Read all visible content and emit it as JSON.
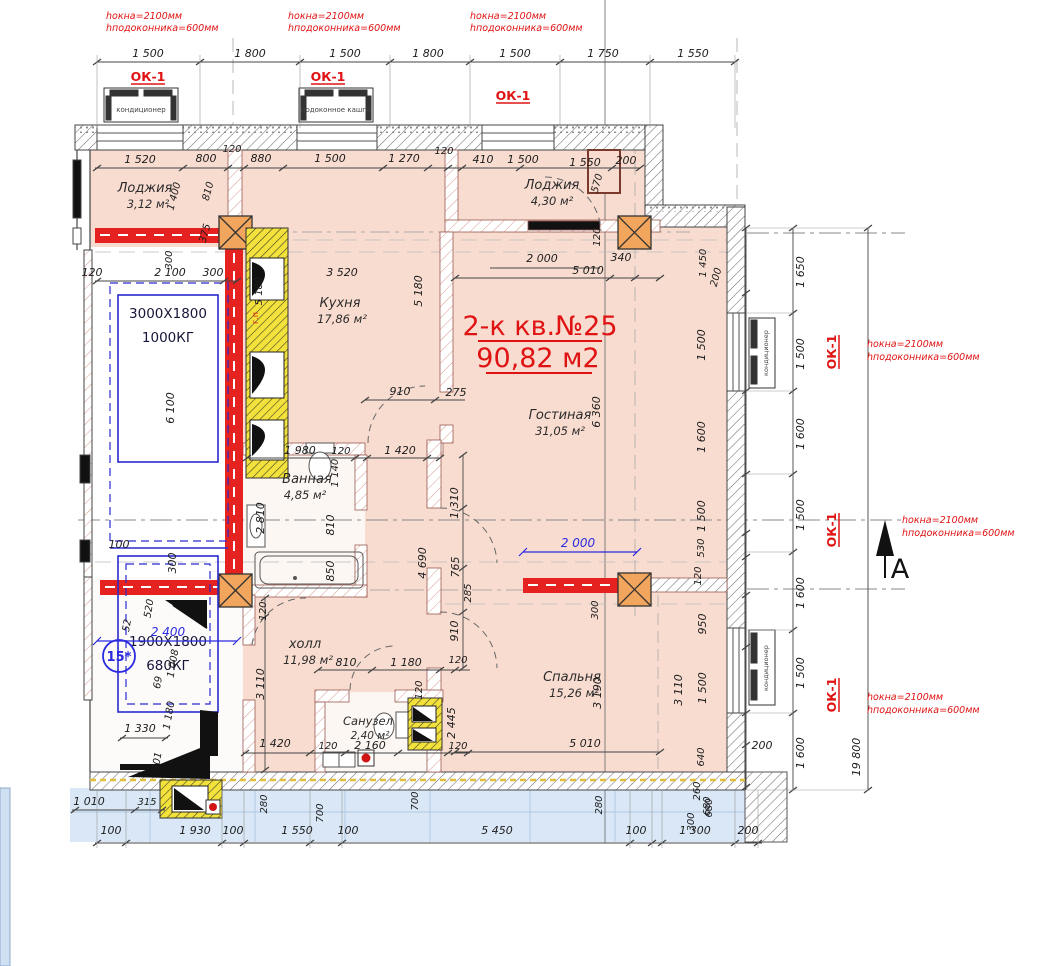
{
  "title": {
    "line1": "2-к кв.№25",
    "line2": "90,82 м2"
  },
  "rooms": [
    {
      "name": "Лоджия",
      "area": "3,12 м²"
    },
    {
      "name": "Кухня",
      "area": "17,86 м²"
    },
    {
      "name": "Лоджия",
      "area": "4,30 м²"
    },
    {
      "name": "Гостиная",
      "area": "31,05 м²"
    },
    {
      "name": "Ванная",
      "area": "4,85 м²"
    },
    {
      "name": "холл",
      "area": "11,98 м²"
    },
    {
      "name": "Санузел",
      "area": "2,40 м²"
    },
    {
      "name": "Спальня",
      "area": "15,26 м²"
    }
  ],
  "elevators": [
    {
      "size": "3000X1800",
      "capacity": "1000КГ"
    },
    {
      "size": "1900X1800",
      "capacity": "680КГ"
    }
  ],
  "labels": {
    "ok1": "ОК-1",
    "gas": "г.п",
    "axis15": "15*",
    "sectionA": "A",
    "conditioner": "кондиционер",
    "planter": "подоконное кашпо"
  },
  "window_note": {
    "l1": "hокна=2100мм",
    "l2": "hподоконника=600мм"
  },
  "blue_dims": [
    "2 000",
    "2 400"
  ],
  "dims": {
    "top": [
      "1 500",
      "1 800",
      "1 500",
      "1 800",
      "1 500",
      "1 750",
      "1 550"
    ],
    "upper": [
      "1 520",
      "800",
      "120",
      "880",
      "1 500",
      "1 270",
      "120",
      "410",
      "1 500",
      "1 550",
      "200"
    ],
    "left_vert": [
      "1 400",
      "810",
      "375",
      "300",
      "5 180"
    ],
    "shaft_col": [
      "120",
      "2 100",
      "300",
      "6 100",
      "100",
      "300"
    ],
    "kitchen": [
      "3 520",
      "5 180",
      "910",
      "275"
    ],
    "living": [
      "2 000",
      "340",
      "5 010",
      "6 360",
      "120",
      "570"
    ],
    "bath": [
      "1 980",
      "120",
      "1 420",
      "1 140",
      "2 810",
      "810",
      "850",
      "120"
    ],
    "hall": [
      "3 110",
      "810",
      "1 180",
      "120",
      "120",
      "2 445",
      "120",
      "2 160",
      "120",
      "1 420",
      "1 330",
      "1 180",
      "301",
      "69",
      "1 008",
      "52",
      "520"
    ],
    "corridor": [
      "1 310",
      "765",
      "285",
      "910",
      "4 690"
    ],
    "bedroom": [
      "5 010",
      "3 190",
      "3 110",
      "300",
      "200"
    ],
    "right_inner": [
      "1 450",
      "200",
      "1 500",
      "1 600",
      "1 500",
      "530",
      "120",
      "950",
      "1 500",
      "640",
      "680",
      "300"
    ],
    "right_outer": [
      "1 650",
      "1 500",
      "1 600",
      "1 500",
      "1 600",
      "1 500",
      "1 600"
    ],
    "overall": "19 800",
    "bottom": [
      "1 010",
      "315",
      "100",
      "1 930",
      "100",
      "1 550",
      "100",
      "5 450",
      "100",
      "1 300",
      "200"
    ],
    "bottom_vert": [
      "280",
      "700",
      "700",
      "280",
      "260",
      "680"
    ]
  }
}
